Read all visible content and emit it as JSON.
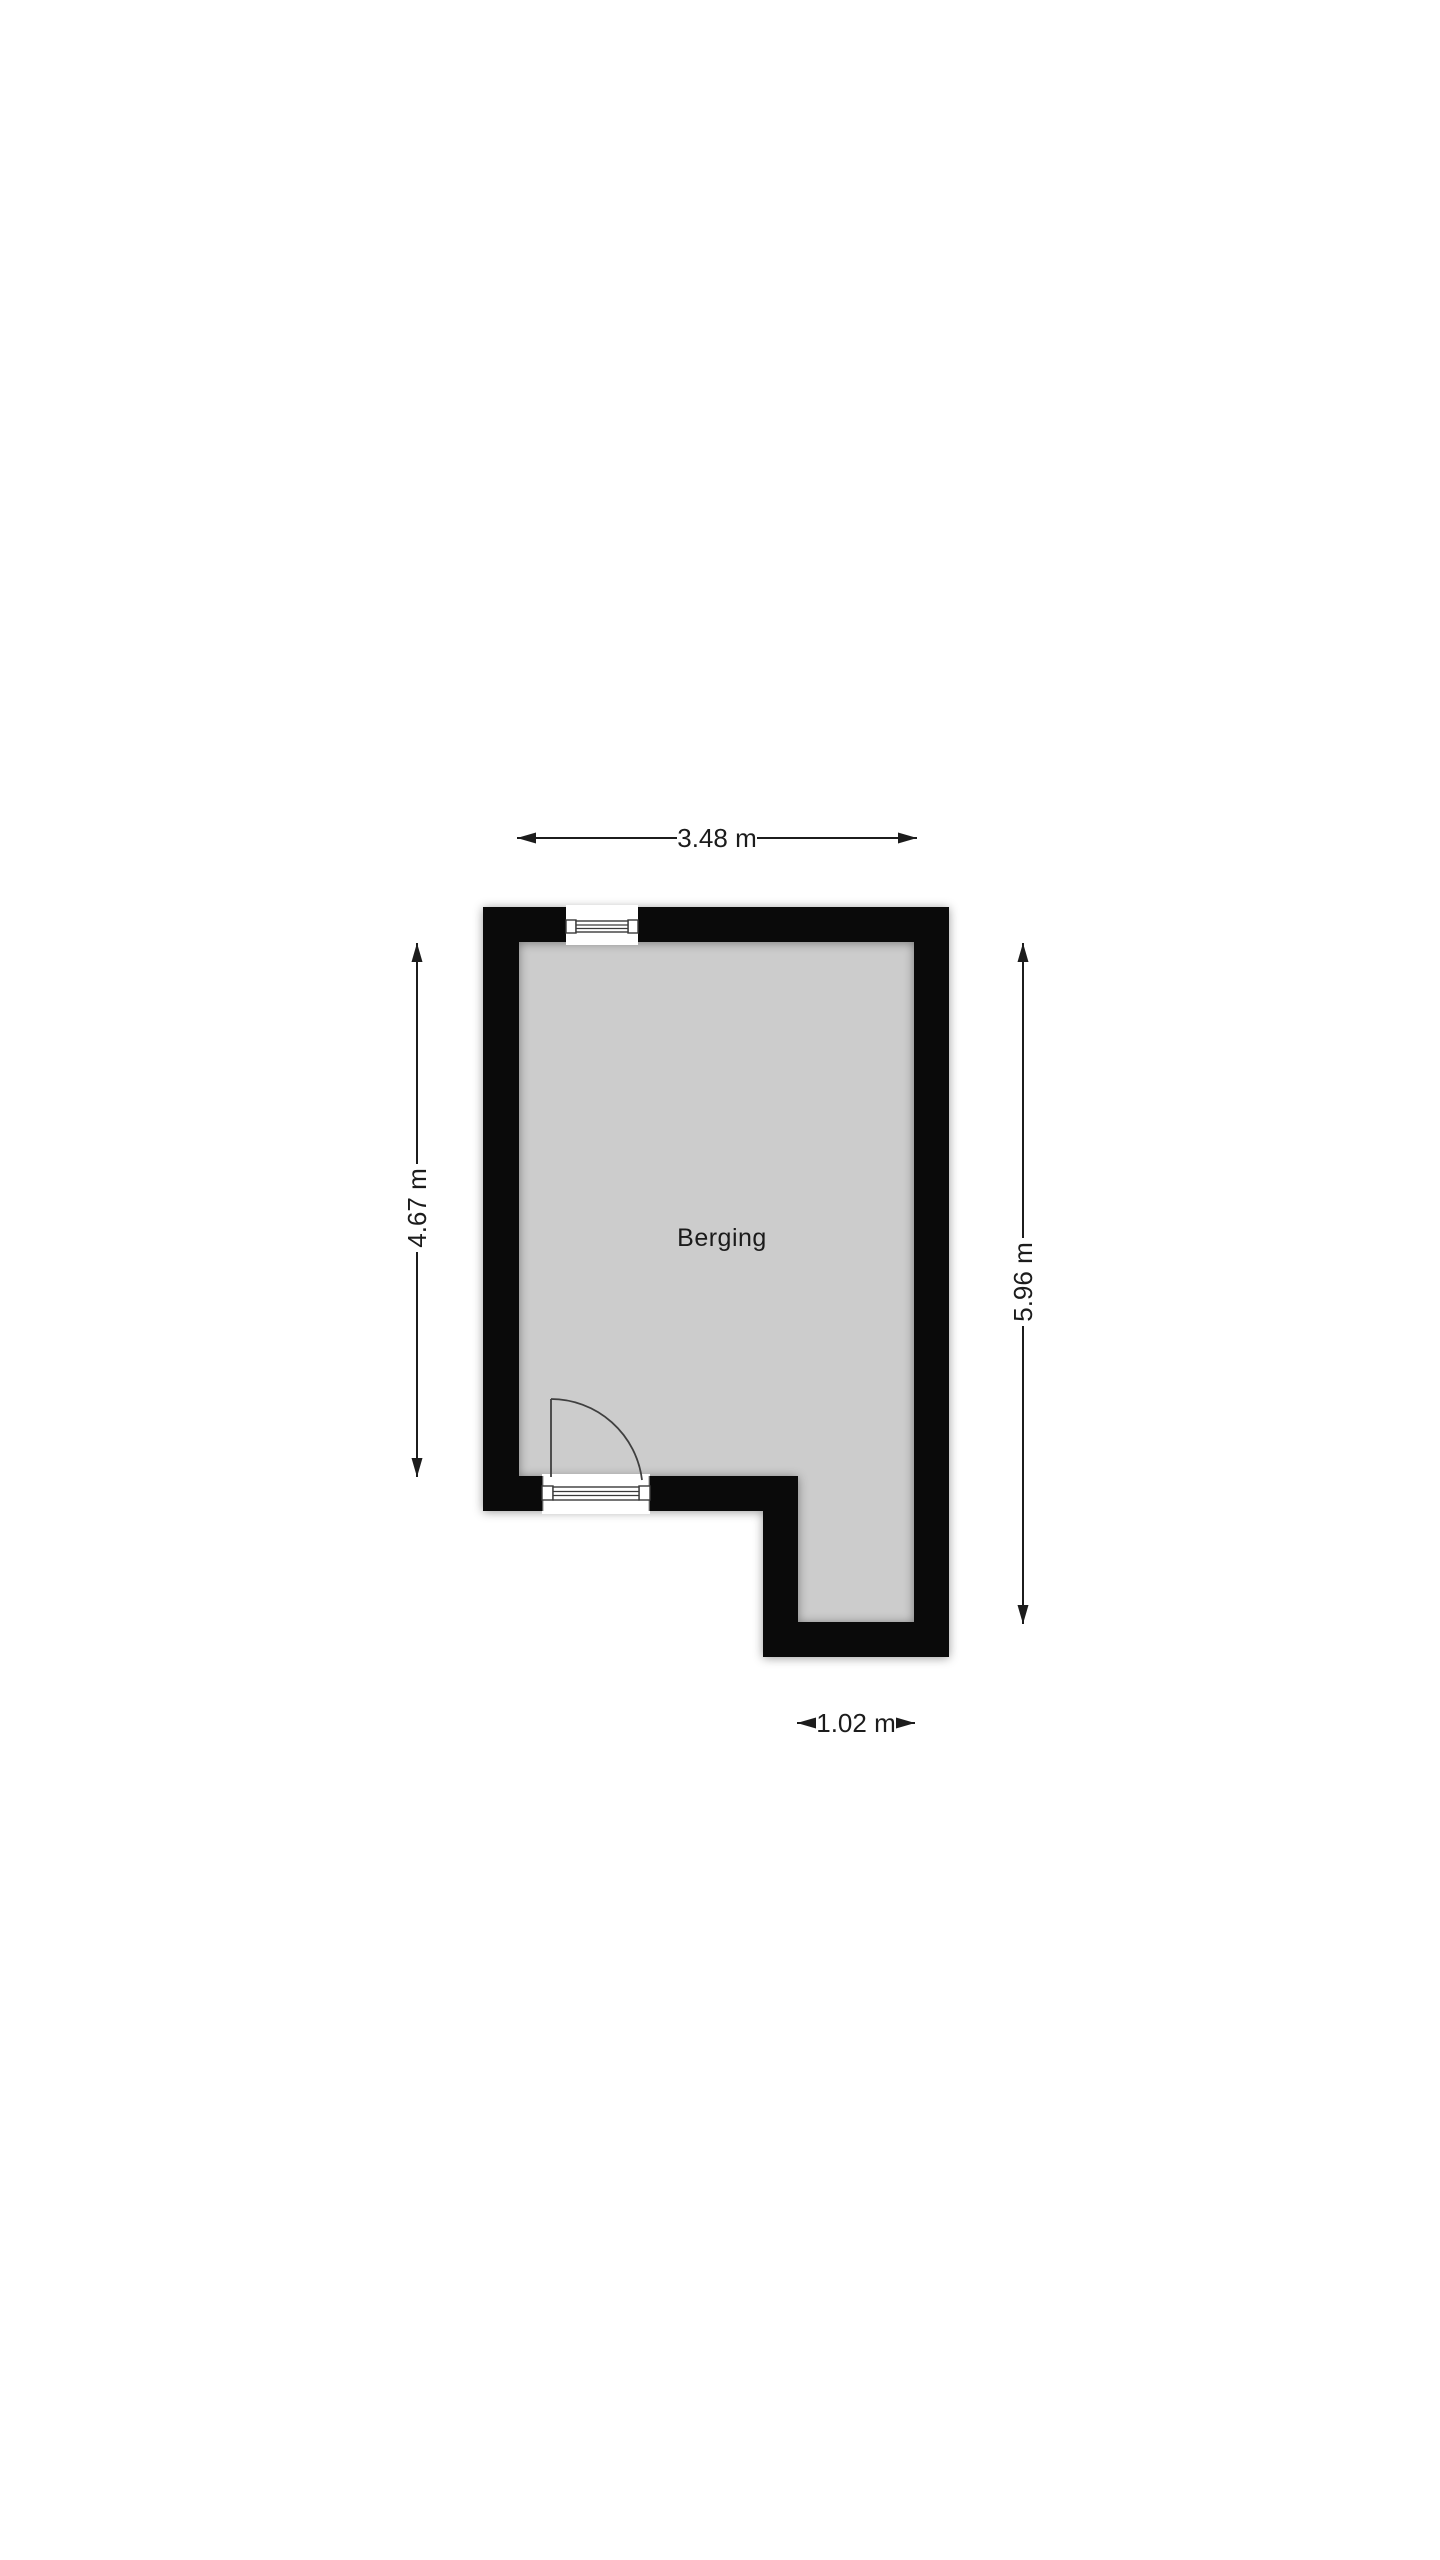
{
  "floorplan": {
    "room": {
      "label": "Berging"
    },
    "dimensions": {
      "width_top": "3.48 m",
      "height_left": "4.67 m",
      "height_right": "5.96 m",
      "width_bottom": "1.02 m"
    },
    "colors": {
      "wall": "#0a0a0a",
      "floor": "#cccccc",
      "background": "#ffffff",
      "dimension": "#1c1c1c"
    }
  }
}
